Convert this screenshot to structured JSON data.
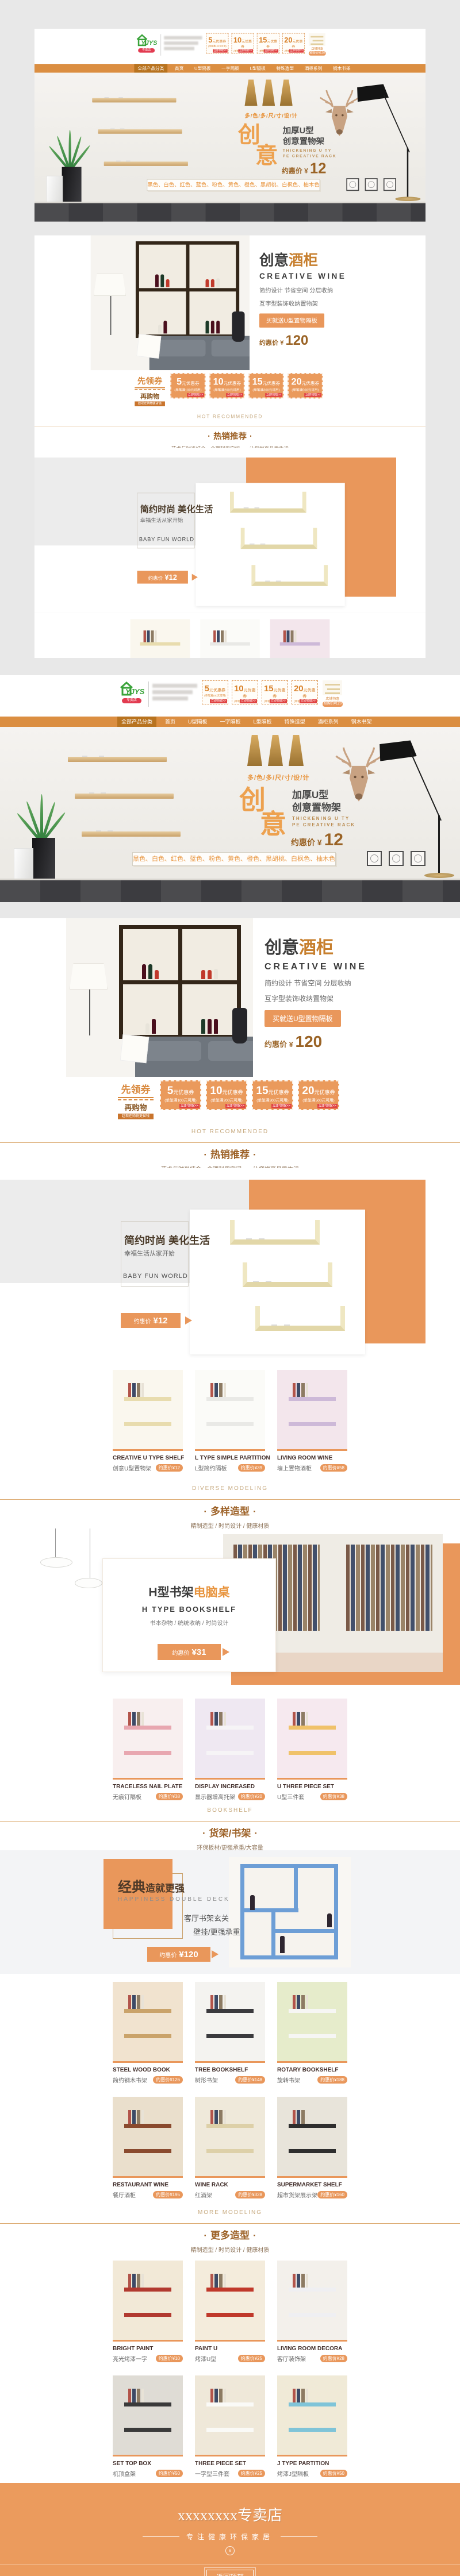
{
  "header": {
    "logo_text": "YJYS",
    "logo_tag": "专卖店",
    "promo_caption": "店铺特惠",
    "promo_price": "抢购价¥120"
  },
  "nav": {
    "items": [
      {
        "label": "全部产品分类"
      },
      {
        "label": "首页"
      },
      {
        "label": "U型隔板"
      },
      {
        "label": "一字隔板"
      },
      {
        "label": "L型隔板"
      },
      {
        "label": "特殊造型"
      },
      {
        "label": "酒柜系列"
      },
      {
        "label": "钢木书架"
      }
    ]
  },
  "coupons": [
    {
      "amount": "5",
      "unit": "元优惠券",
      "condition": "(单笔满100元可用)",
      "action": "立即领取>>"
    },
    {
      "amount": "10",
      "unit": "元优惠券",
      "condition": "(单笔满200元可用)",
      "action": "立即领取>>"
    },
    {
      "amount": "15",
      "unit": "元优惠券",
      "condition": "(单笔满300元可用)",
      "action": "立即领取>>"
    },
    {
      "amount": "20",
      "unit": "元优惠券",
      "condition": "(单笔满500元可用)",
      "action": "立即领取>>"
    }
  ],
  "coupon_strip": {
    "lead1": "先领券",
    "lead2": "再购物",
    "tag": "趁现在购物更省钱"
  },
  "banner": {
    "multi": "多/色/多/尺/寸/设/计",
    "char1": "创",
    "char2": "意",
    "sub1": "加厚U型",
    "sub2": "创意置物架",
    "en1": "THICKENING U TY",
    "en2": "PE CREATIVE RACK",
    "price_label": "约惠价",
    "price_cur": "¥",
    "price": "12",
    "colors": "黑色、白色、红色、蓝色、粉色、黄色、橙色、黑胡桃、白枫色、柚木色"
  },
  "wine": {
    "t1": "创意",
    "t2": "酒柜",
    "en": "CREATIVE  WINE",
    "l1": "简约设计  节省空间  分层收纳",
    "l2": "互字型装饰收纳置物架",
    "btn": "买就送U型置物隔板",
    "price_label": "约惠价",
    "price_cur": "¥",
    "price": "120"
  },
  "headings": {
    "hot": {
      "en": "HOT  RECOMMENDED",
      "cn": "热销推荐",
      "sub": "艺术与时尚结合，合理利用空间——让您悦享品质生活"
    },
    "diverse": {
      "en": "DIVERSE  MODELING",
      "cn": "多样造型",
      "sub": "精制造型 / 时尚设计 / 健康材质"
    },
    "bookshelf": {
      "en": "BOOKSHELF",
      "cn": "货架/书架",
      "sub": "环保板材/更强承重/大容量"
    },
    "more": {
      "en": "MORE  MODELING",
      "cn": "更多造型",
      "sub": "精制造型 / 时尚设计 / 健康材质"
    }
  },
  "jianyue": {
    "title": "简约时尚 美化生活",
    "sub": "幸福生活从家开始",
    "en": "BABY FUN WORLD",
    "price": "¥12"
  },
  "h_section": {
    "t1": "H型书架",
    "t2": "电脑桌",
    "en": "H TYPE BOOKSHELF",
    "sub": "书本杂物  / 统统收纳 / 时尚设计",
    "price": "¥31"
  },
  "classic": {
    "t1": "经典",
    "t2": "造就更强",
    "en": "HAPPINESS DOUBLE DECK",
    "l1": "客厅书架玄关",
    "l2": "壁挂/更强承重",
    "price": "¥120"
  },
  "labels": {
    "price_prefix": "约惠价"
  },
  "products": [
    {
      "en": "CREATIVE U TYPE SHELF",
      "cn": "创意U型置物架",
      "price": "¥12"
    },
    {
      "en": "L TYPE SIMPLE PARTITION",
      "cn": "L型简约隔板",
      "price": "¥39"
    },
    {
      "en": "LIVING ROOM WINE",
      "cn": "墙上置物酒柜",
      "price": "¥58"
    },
    {
      "en": "TRACELESS NAIL PLATE",
      "cn": "无痕钉隔板",
      "price": "¥38"
    },
    {
      "en": "DISPLAY INCREASED",
      "cn": "显示器增高托架",
      "price": "¥20"
    },
    {
      "en": "U THREE PIECE SET",
      "cn": "U型三件套",
      "price": "¥38"
    },
    {
      "en": "STEEL WOOD BOOK",
      "cn": "简约钢木书架",
      "price": "¥126"
    },
    {
      "en": "TREE BOOKSHELF",
      "cn": "树形书架",
      "price": "¥148"
    },
    {
      "en": "ROTARY BOOKSHELF",
      "cn": "旋转书架",
      "price": "¥188"
    },
    {
      "en": "RESTAURANT WINE",
      "cn": "餐厅酒柜",
      "price": "¥195"
    },
    {
      "en": "WINE RACK",
      "cn": "红酒架",
      "price": "¥328"
    },
    {
      "en": "SUPERMARKET SHELF",
      "cn": "超市货架展示架",
      "price": "¥160"
    },
    {
      "en": "BRIGHT PAINT",
      "cn": "亮光烤漆一字",
      "price": "¥10"
    },
    {
      "en": "PAINT U",
      "cn": "烤漆U型",
      "price": "¥25"
    },
    {
      "en": "LIVING ROOM DECORA",
      "cn": "客厅装饰架",
      "price": "¥28"
    },
    {
      "en": "SET TOP BOX",
      "cn": "机顶盒架",
      "price": "¥50"
    },
    {
      "en": "THREE PIECE SET",
      "cn": "一字型三件套",
      "price": "¥25"
    },
    {
      "en": "J TYPE PARTITION",
      "cn": "烤漆J型隔板",
      "price": "¥50"
    }
  ],
  "footer": {
    "title": "xxxxxxxx专卖店",
    "slogan": "专注健康环保家居",
    "back_top": "返回顶部"
  },
  "colors": {
    "accent": "#e9975b",
    "nav_bar": "#db8e41",
    "footer": "#eb9b5d"
  }
}
